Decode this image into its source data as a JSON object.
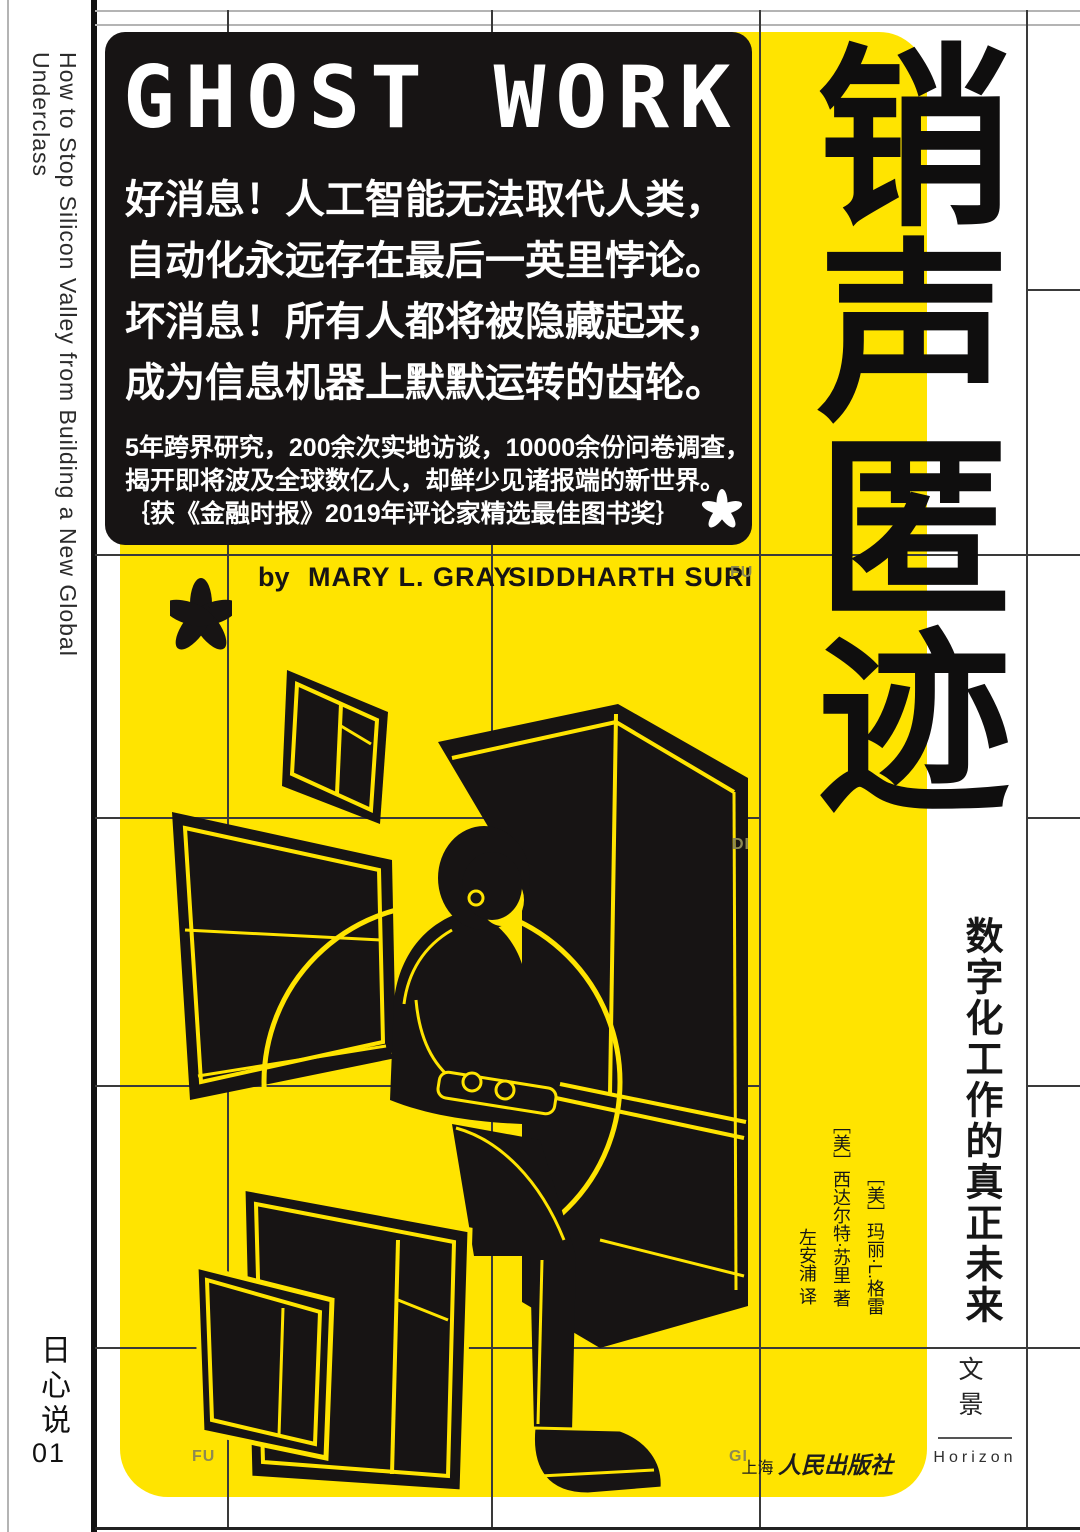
{
  "cover": {
    "logo": "GHOST WORK",
    "title_cn": "销声匿迹",
    "subtitle_cn": "数字化工作的真正未来",
    "spine_text_en": "How to Stop Silicon Valley from Building a New Global Underclass",
    "series": {
      "name": "日心说",
      "number": "01"
    },
    "info_box": {
      "headline_lines": [
        "好消息！人工智能无法取代人类，",
        "自动化永远存在最后一英里悖论。",
        "坏消息！所有人都将被隐藏起来，",
        "成为信息机器上默默运转的齿轮。"
      ],
      "subline_lines": [
        "5年跨界研究，200余次实地访谈，10000余份问卷调查，",
        "揭开即将波及全球数亿人，却鲜少见诸报端的新世界。",
        "｛获《金融时报》2019年评论家精选最佳图书奖｝"
      ]
    },
    "byline": {
      "by": "by",
      "author_1": "MARY L. GRAY",
      "author_2": "SIDDHARTH SURI"
    },
    "credits": {
      "author_1_cn": "［美］玛丽·L.格雷",
      "author_2_cn": "［美］西达尔特·苏里 著",
      "translator_cn": "左安浦 译"
    },
    "scatter_letters": {
      "byline_right": "FU",
      "middle_right": "DI",
      "bottom_left": "FU",
      "bottom_right": "GI"
    },
    "publisher": {
      "name_prefix": "上海",
      "name_script": "人民出版社",
      "imprint_cn": "文景",
      "imprint_en": "Horizon"
    },
    "colors": {
      "yellow": "#FFE400",
      "ink": "#171414",
      "scatter_letter": "#8d8a52"
    }
  }
}
